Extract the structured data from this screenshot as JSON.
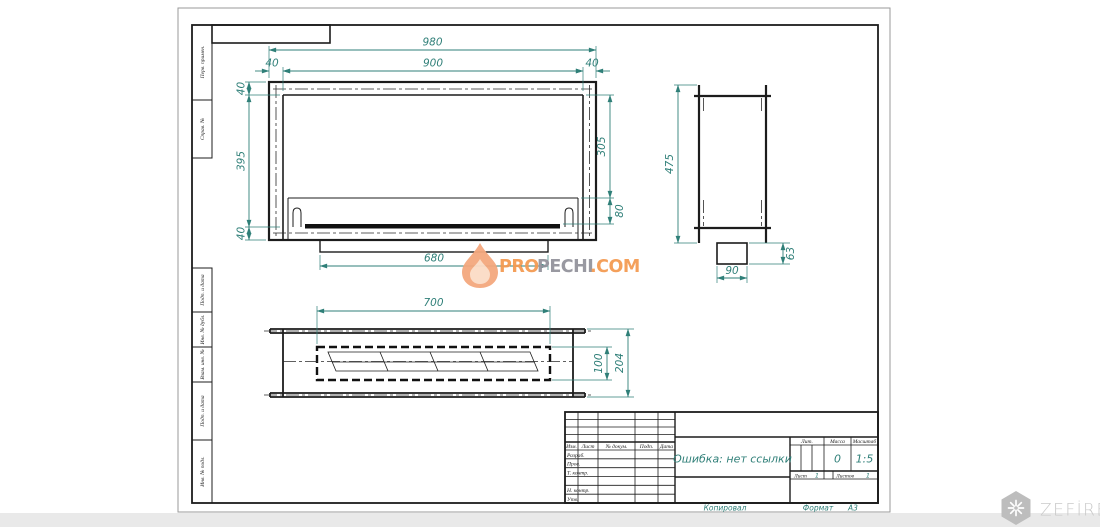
{
  "colors": {
    "drawing_line": "#1c1c1c",
    "dimension_teal": "#2F7F78",
    "watermark_orange": "#F49B53",
    "watermark_gray": "#94949D",
    "flame_fill": "#F4A87E",
    "zefire_gray": "#BDBDBD"
  },
  "icons": {
    "flame": "flame-icon",
    "snowflake": "snowflake-hexagon-icon"
  },
  "margin_labels": {
    "perv": "Перв. примен.",
    "sprav": "Справ. №",
    "podp1": "Подп. и дата",
    "inv_dubl": "Инв. № дубл.",
    "vzam": "Взам. инв. №",
    "podp2": "Подп. и дата",
    "inv_podl": "Инв. № подл."
  },
  "dims": {
    "front": {
      "overall_width": "980",
      "inner_width": "900",
      "offset_left": "40",
      "offset_right": "40",
      "frame_top": "40",
      "inner_height": "395",
      "frame_bottom": "40",
      "opening_height": "305",
      "tray_height": "80",
      "burner_length": "680"
    },
    "side": {
      "height": "475",
      "duct_height": "63",
      "duct_width": "90"
    },
    "plan": {
      "opening_length": "700",
      "depth": "204",
      "opening_depth": "100"
    }
  },
  "title_block": {
    "col_izm": "Изм.",
    "col_list": "Лист",
    "col_doc": "№ докум.",
    "col_podp": "Подп.",
    "col_data": "Дата",
    "row_razrab": "Разраб.",
    "row_prov": "Пров.",
    "row_tkontr": "Т. контр.",
    "row_nkontr": "Н. контр.",
    "row_utv": "Утв.",
    "designation": "Ошибка: нет ссылки",
    "lit": "Лит.",
    "massa": "Масса",
    "masshtab": "Масштаб",
    "massa_value": "0",
    "masshtab_value": "1:5",
    "list": "Лист",
    "list_value": "1",
    "listov": "Листов",
    "listov_value": "1",
    "kopiroval": "Копировал",
    "format_label": "Формат",
    "format_value": "А3"
  },
  "watermark": {
    "pro": "PRO",
    "pechi": "PECHI",
    "com": ".COM"
  },
  "brand": {
    "name": "ZEFİRE"
  }
}
